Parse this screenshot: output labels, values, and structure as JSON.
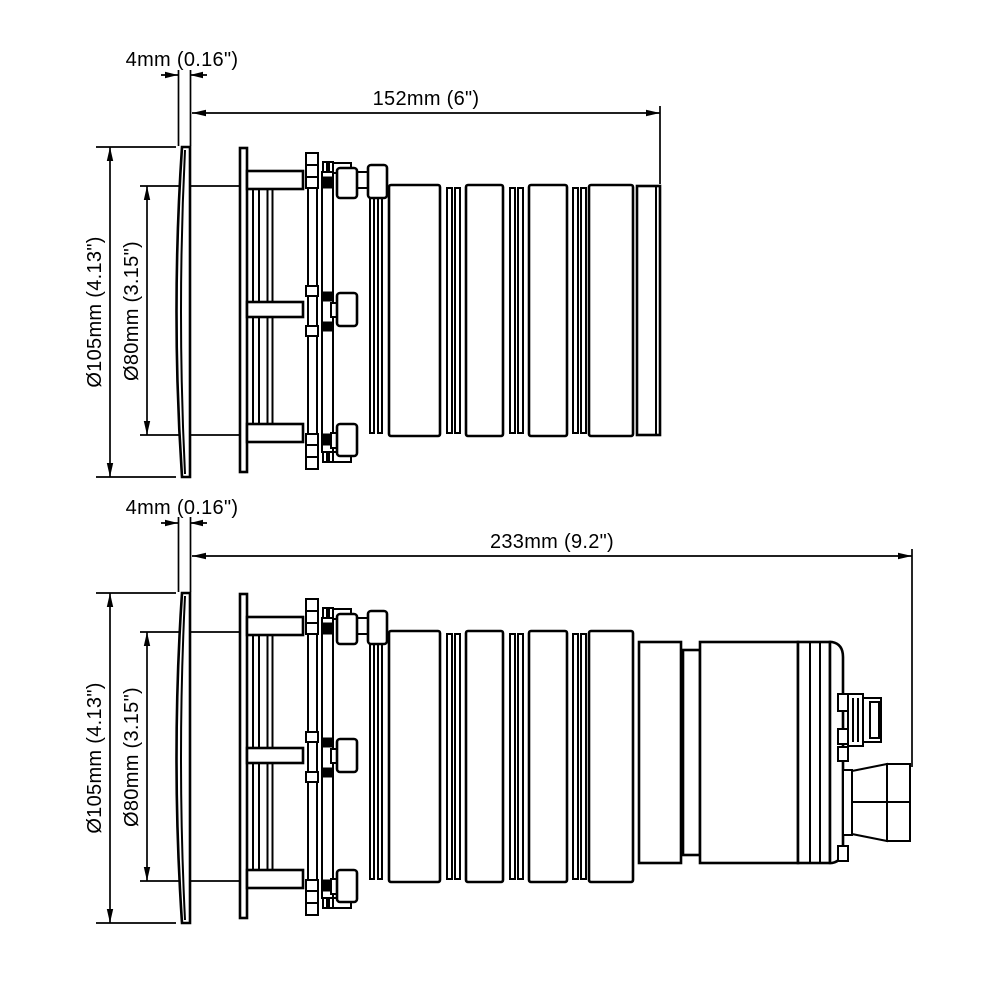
{
  "page": {
    "background": "#ffffff",
    "line_color": "#000000"
  },
  "drawing": {
    "type": "technical-dimension-drawing",
    "views": [
      {
        "id": "side-view-short",
        "labels": {
          "flange_thickness": "4mm (0.16\")",
          "overall_length": "152mm (6\")",
          "flange_diameter": "Ø105mm (4.13\")",
          "body_diameter": "Ø80mm (3.15\")"
        }
      },
      {
        "id": "side-view-long",
        "labels": {
          "flange_thickness": "4mm (0.16\")",
          "overall_length": "233mm (9.2\")",
          "flange_diameter": "Ø105mm (4.13\")",
          "body_diameter": "Ø80mm (3.15\")"
        }
      }
    ]
  }
}
